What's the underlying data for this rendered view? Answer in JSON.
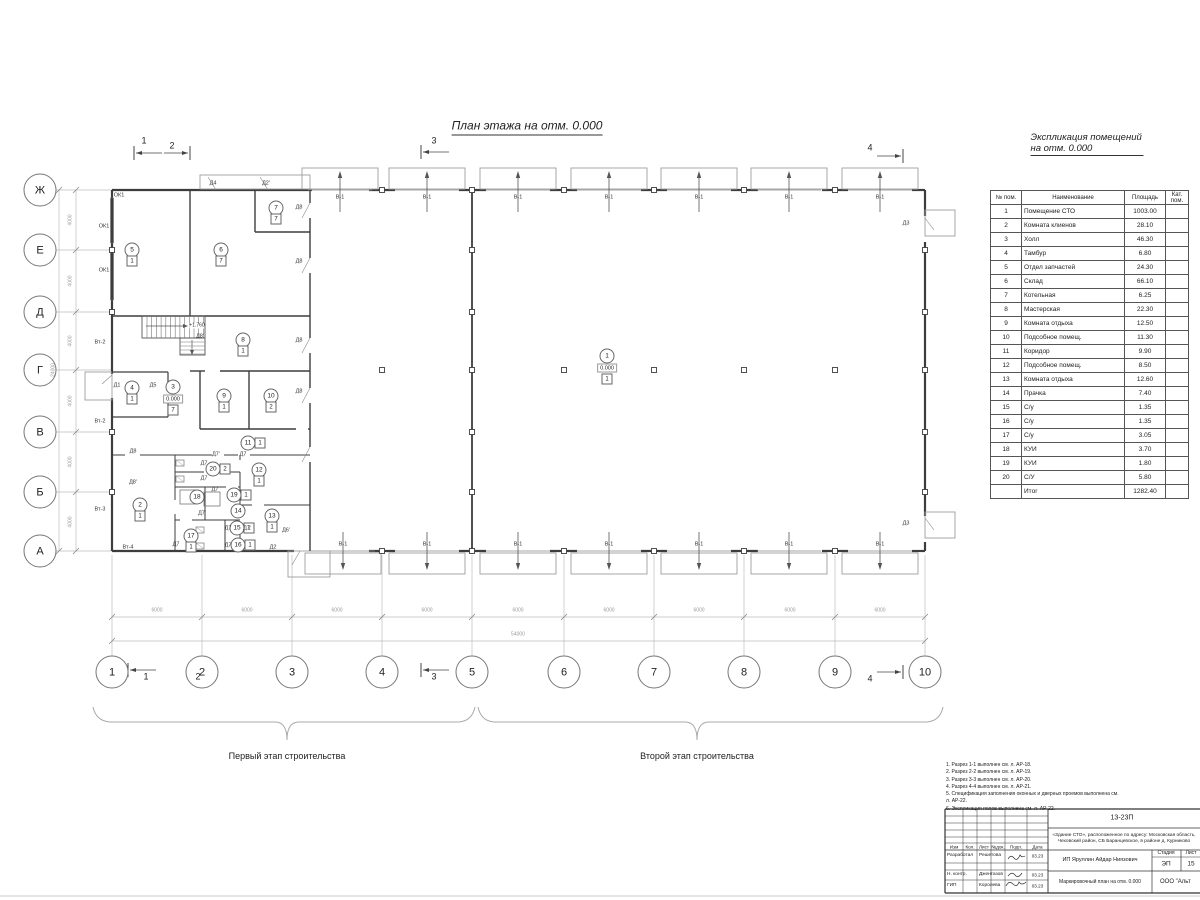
{
  "sheet": {
    "plan_title": "План этажа на отм. 0.000",
    "schedule_title": "Экспликация помещений на отм. 0.000",
    "stage1_label": "Первый этап строительства",
    "stage2_label": "Второй этап строительства"
  },
  "axes": {
    "rows": [
      "Ж",
      "Е",
      "Д",
      "Г",
      "В",
      "Б",
      "А"
    ],
    "cols": [
      "1",
      "2",
      "3",
      "4",
      "5",
      "6",
      "7",
      "8",
      "9",
      "10"
    ]
  },
  "dimensions": {
    "bay": "6000",
    "total_bottom": "54000",
    "side_bay": "4000",
    "total_left": "24000"
  },
  "section_marks": [
    "1",
    "2",
    "3",
    "4"
  ],
  "gate_label": "В-1",
  "stair_elevation": "+1.760",
  "rooms": [
    {
      "n": "1",
      "x": 607,
      "y": 356,
      "e": "0.000",
      "f": "1"
    },
    {
      "n": "2",
      "x": 140,
      "y": 505,
      "f": "1"
    },
    {
      "n": "3",
      "x": 173,
      "y": 387,
      "e": "0.000",
      "f": "7"
    },
    {
      "n": "4",
      "x": 132,
      "y": 388,
      "f": "1"
    },
    {
      "n": "5",
      "x": 132,
      "y": 250,
      "f": "1"
    },
    {
      "n": "6",
      "x": 221,
      "y": 250,
      "f": "7"
    },
    {
      "n": "7",
      "x": 276,
      "y": 208,
      "f": "7"
    },
    {
      "n": "8",
      "x": 243,
      "y": 340,
      "f": "1"
    },
    {
      "n": "9",
      "x": 224,
      "y": 396,
      "f": "1"
    },
    {
      "n": "10",
      "x": 271,
      "y": 396,
      "f": "2"
    },
    {
      "n": "11",
      "x": 248,
      "y": 443,
      "f": "1",
      "side": true
    },
    {
      "n": "12",
      "x": 259,
      "y": 470,
      "f": "1"
    },
    {
      "n": "13",
      "x": 272,
      "y": 516,
      "f": "1"
    },
    {
      "n": "14",
      "x": 238,
      "y": 511
    },
    {
      "n": "15",
      "x": 237,
      "y": 528,
      "f": "1",
      "side": true
    },
    {
      "n": "16",
      "x": 238,
      "y": 545,
      "f": "1",
      "side": true
    },
    {
      "n": "17",
      "x": 191,
      "y": 536,
      "f": "1"
    },
    {
      "n": "18",
      "x": 197,
      "y": 497
    },
    {
      "n": "19",
      "x": 234,
      "y": 495,
      "f": "1",
      "side": true
    },
    {
      "n": "20",
      "x": 213,
      "y": 469,
      "f": "2",
      "side": true
    }
  ],
  "labels": {
    "doors": [
      {
        "t": "Д4",
        "x": 213,
        "y": 184
      },
      {
        "t": "Д2'",
        "x": 266,
        "y": 184
      },
      {
        "t": "Д8",
        "x": 299,
        "y": 208
      },
      {
        "t": "Д8",
        "x": 299,
        "y": 262
      },
      {
        "t": "Д8",
        "x": 299,
        "y": 341
      },
      {
        "t": "Д8",
        "x": 299,
        "y": 392
      },
      {
        "t": "Д8'",
        "x": 200,
        "y": 337
      },
      {
        "t": "Д8",
        "x": 133,
        "y": 452
      },
      {
        "t": "Д8'",
        "x": 133,
        "y": 483
      },
      {
        "t": "Д1",
        "x": 117,
        "y": 386
      },
      {
        "t": "Д5",
        "x": 153,
        "y": 386
      },
      {
        "t": "Д3",
        "x": 906,
        "y": 224
      },
      {
        "t": "Д3",
        "x": 906,
        "y": 524
      },
      {
        "t": "Д2",
        "x": 273,
        "y": 548
      },
      {
        "t": "Д6'",
        "x": 286,
        "y": 531
      },
      {
        "t": "Д7'",
        "x": 216,
        "y": 455
      },
      {
        "t": "Д7",
        "x": 243,
        "y": 455
      },
      {
        "t": "Д7",
        "x": 204,
        "y": 464
      },
      {
        "t": "Д7",
        "x": 204,
        "y": 479
      },
      {
        "t": "Д7",
        "x": 215,
        "y": 490
      },
      {
        "t": "Д7'",
        "x": 202,
        "y": 514
      },
      {
        "t": "Д7",
        "x": 228,
        "y": 529
      },
      {
        "t": "Д7'",
        "x": 247,
        "y": 529
      },
      {
        "t": "Д7",
        "x": 176,
        "y": 545
      },
      {
        "t": "Д7",
        "x": 228,
        "y": 546
      }
    ],
    "windows": [
      {
        "t": "ОК1",
        "x": 119,
        "y": 196
      },
      {
        "t": "ОК1",
        "x": 104,
        "y": 227
      },
      {
        "t": "ОК1",
        "x": 104,
        "y": 271
      }
    ],
    "vents": [
      {
        "t": "Вт-2",
        "x": 100,
        "y": 343
      },
      {
        "t": "Вт-2",
        "x": 100,
        "y": 422
      },
      {
        "t": "Вт-3",
        "x": 100,
        "y": 510
      },
      {
        "t": "Вт-4",
        "x": 128,
        "y": 548
      }
    ]
  },
  "schedule": {
    "headers": [
      "№ пом.",
      "Наименование",
      "Площадь",
      "Кат. пом."
    ],
    "rows": [
      [
        "1",
        "Помещение СТО",
        "1003.00",
        ""
      ],
      [
        "2",
        "Комната клиенов",
        "28.10",
        ""
      ],
      [
        "3",
        "Холл",
        "46.30",
        ""
      ],
      [
        "4",
        "Тамбур",
        "6.80",
        ""
      ],
      [
        "5",
        "Отдел запчастей",
        "24.30",
        ""
      ],
      [
        "6",
        "Склад",
        "66.10",
        ""
      ],
      [
        "7",
        "Котельная",
        "6.25",
        ""
      ],
      [
        "8",
        "Мастерская",
        "22.30",
        ""
      ],
      [
        "9",
        "Комната отдыха",
        "12.50",
        ""
      ],
      [
        "10",
        "Подсобное помещ.",
        "11.30",
        ""
      ],
      [
        "11",
        "Коридор",
        "9.90",
        ""
      ],
      [
        "12",
        "Подсобное помещ.",
        "8.50",
        ""
      ],
      [
        "13",
        "Комната отдыха",
        "12.60",
        ""
      ],
      [
        "14",
        "Прачка",
        "7.40",
        ""
      ],
      [
        "15",
        "С/у",
        "1.35",
        ""
      ],
      [
        "16",
        "С/у",
        "1.35",
        ""
      ],
      [
        "17",
        "С/у",
        "3.05",
        ""
      ],
      [
        "18",
        "КУИ",
        "3.70",
        ""
      ],
      [
        "19",
        "КУИ",
        "1.80",
        ""
      ],
      [
        "20",
        "С/У",
        "5.80",
        ""
      ]
    ],
    "total_label": "Итог",
    "total_value": "1282.40"
  },
  "notes": [
    "1. Разрез 1-1 выполнен см. л. АР-18.",
    "2. Разрез 2-2 выполнен см. л. АР-19.",
    "3. Разрез 3-3 выполнен см. л. АР-20.",
    "4. Разрез 4-4 выполнен см. л. АР-21.",
    "5. Спецификация заполнения оконных и дверных проемов выполнена см. л. АР-22.",
    "6. Экспликация полов выполнена см. л. АР-22."
  ],
  "titleblock": {
    "code": "13-23П",
    "object": "«Здание СТО», расположенное по адресу: Московская область, Чеховский район, СБ Баранцевское, в районе д. Курниково",
    "cols": [
      "Изм",
      "Кол.",
      "Лист",
      "№док.",
      "Подп.",
      "Дата"
    ],
    "rows": [
      {
        "role": "Разработал",
        "name": "Решетова",
        "date": "03.23"
      },
      {
        "role": "Н. контр.",
        "name": "Джентазов",
        "date": "03.23"
      },
      {
        "role": "ГИП",
        "name": "Королева",
        "date": "03.23"
      }
    ],
    "client": "ИП Яруллин Айдар Ниязович",
    "stage_label": "Стадия",
    "sheet_label": "Лист",
    "stage": "ЭП",
    "sheet_no": "15",
    "doc_title": "Маркировочный план на отм. 0.000",
    "company": "ООО \"Альт"
  }
}
